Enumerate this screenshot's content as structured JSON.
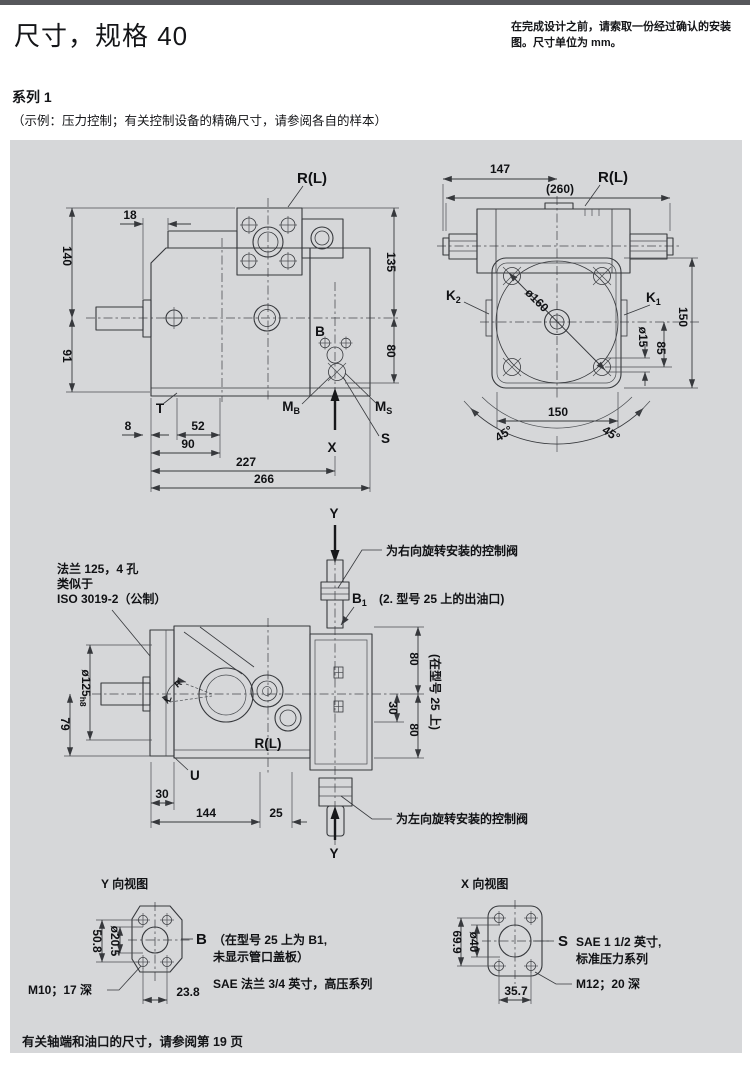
{
  "page": {
    "title": "尺寸，规格 40",
    "header_note": "在完成设计之前，请索取一份经过确认的安装图。尺寸单位为 mm。",
    "series_heading": "系列 1",
    "series_note": "（示例：压力控制；有关控制设备的精确尺寸，请参阅各自的样本）",
    "footer_note": "有关轴端和油口的尺寸，请参阅第 19 页"
  },
  "side_view": {
    "port_top": "R(L)",
    "labels": {
      "b": "B",
      "t": "T",
      "s": "S",
      "x": "X",
      "m": "M",
      "mb_sub": "B",
      "ms_sub": "S"
    },
    "dims": {
      "d18": "18",
      "d140": "140",
      "d91": "91",
      "d135": "135",
      "d80": "80",
      "d8": "8",
      "d52": "52",
      "d90": "90",
      "d227": "227",
      "d266": "266"
    }
  },
  "rear_view": {
    "port_top": "R(L)",
    "k": "K",
    "k1_sub": "1",
    "k2_sub": "2",
    "dims": {
      "d147": "147",
      "d260": "(260)",
      "d160": "ø160",
      "d15": "ø15",
      "d85": "85",
      "d150_side": "150",
      "d150_bottom": "150",
      "d45_left": "45°",
      "d45_right": "45°"
    }
  },
  "top_view": {
    "y_axis": "Y",
    "flange_note_1": "法兰 125，4 孔",
    "flange_note_2": "类似于",
    "flange_note_3": "ISO 3019-2（公制）",
    "right_valve_note": "为右向旋转安装的控制阀",
    "left_valve_note": "为左向旋转安装的控制阀",
    "b1": "B",
    "b1_sub": "1",
    "b1_note": "(2. 型号 25 上的出油口)",
    "frame_note": "(在型号 25 上)",
    "port_label": "R(L)",
    "u": "U",
    "rot_r": "R",
    "rot_l": "L",
    "dims": {
      "d125": "ø125",
      "d125_sub": "h8",
      "d79": "79",
      "d80_top": "80",
      "d30_right": "30",
      "d80_bottom": "80",
      "d30_left": "30",
      "d144": "144",
      "d25": "25"
    }
  },
  "y_view": {
    "title": "Y 向视图",
    "port": "B",
    "port_note_1": "（在型号 25 上为 B1,",
    "port_note_2": "未显示管口盖板）",
    "sae_note": "SAE 法兰 3/4 英寸，高压系列",
    "thread_note": "M10；17 深",
    "dims": {
      "d508": "50.8",
      "d205": "ø20.5",
      "d238": "23.8"
    }
  },
  "x_view": {
    "title": "X 向视图",
    "port": "S",
    "port_note_1": "SAE 1 1/2 英寸,",
    "port_note_2": "标准压力系列",
    "thread_note": "M12；20 深",
    "dims": {
      "d699": "69.9",
      "d40": "ø40",
      "d357": "35.7"
    }
  }
}
